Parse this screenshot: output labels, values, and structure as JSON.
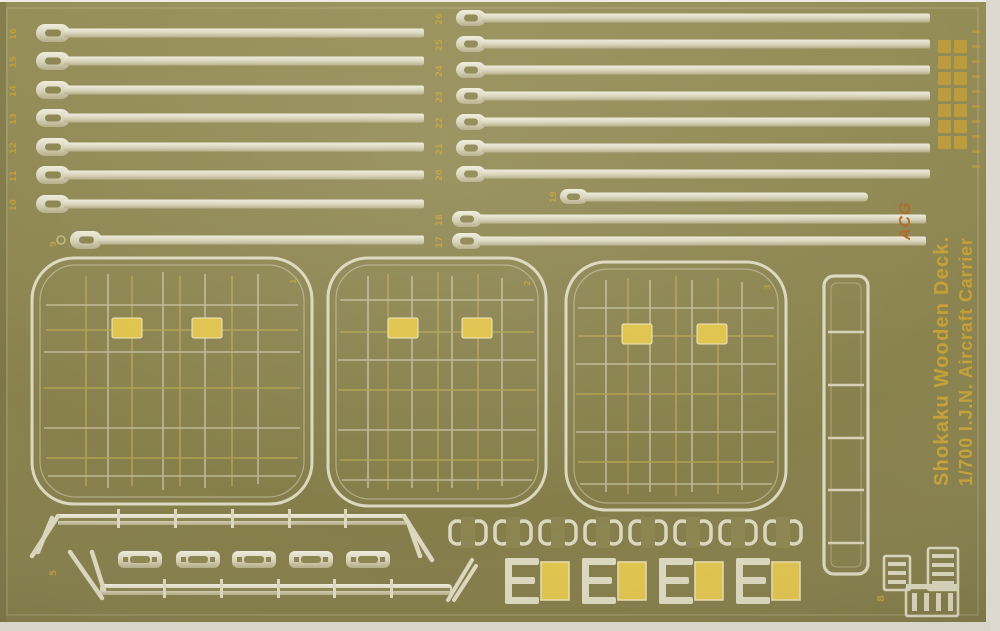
{
  "product": {
    "title_line1": "1/700 I.J.N. Aircraft Carrier",
    "title_line2": "Shokaku Wooden Deck.",
    "brand": "ACG"
  },
  "part_labels": {
    "left_strips": [
      "16",
      "15",
      "14",
      "13",
      "12",
      "11",
      "10",
      "9"
    ],
    "right_strips": [
      "26",
      "25",
      "24",
      "23",
      "22",
      "21",
      "20",
      "19",
      "18",
      "17"
    ],
    "elevators": [
      "1",
      "2",
      "3"
    ],
    "rails": "5",
    "platform": "8"
  },
  "colors": {
    "sheet_olive": "#8b8450",
    "etched_metal": "#dcd7bf",
    "grid_yellow": "#c0aa54",
    "pad_yellow": "#e0c34c",
    "gold_text": "#c6a036",
    "brand_red_gold": "#b06a2a",
    "photo_background": "#efece7"
  }
}
